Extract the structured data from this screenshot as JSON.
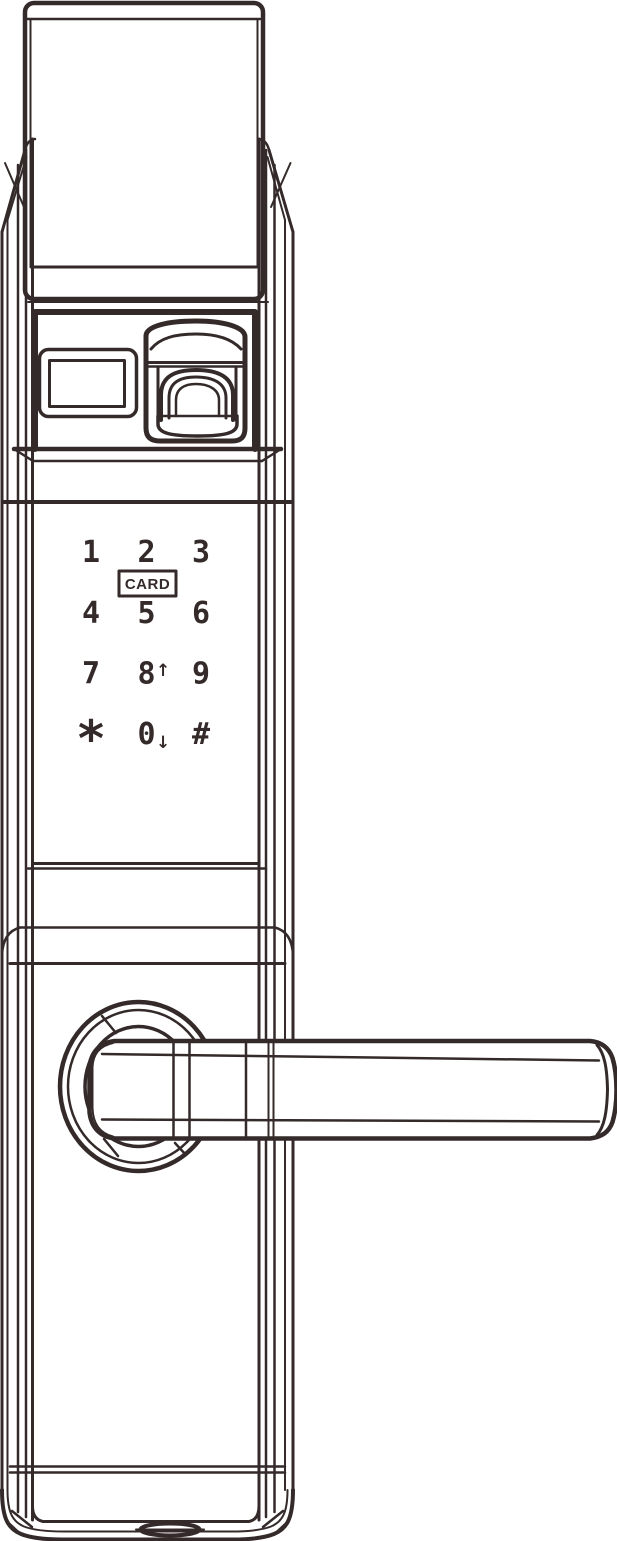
{
  "colors": {
    "line": "#342a2a",
    "background": "#ffffff"
  },
  "keypad": {
    "card_label": "CARD",
    "rows": [
      {
        "keys": [
          {
            "label": "1"
          },
          {
            "label": "2"
          },
          {
            "label": "3"
          }
        ]
      },
      {
        "keys": [
          {
            "label": "4"
          },
          {
            "label": "5"
          },
          {
            "label": "6"
          }
        ]
      },
      {
        "keys": [
          {
            "label": "7"
          },
          {
            "label": "8",
            "suffix": "↑"
          },
          {
            "label": "9"
          }
        ]
      },
      {
        "keys": [
          {
            "label": "*"
          },
          {
            "label": "0",
            "suffix": "↓"
          },
          {
            "label": "#"
          }
        ]
      }
    ]
  }
}
